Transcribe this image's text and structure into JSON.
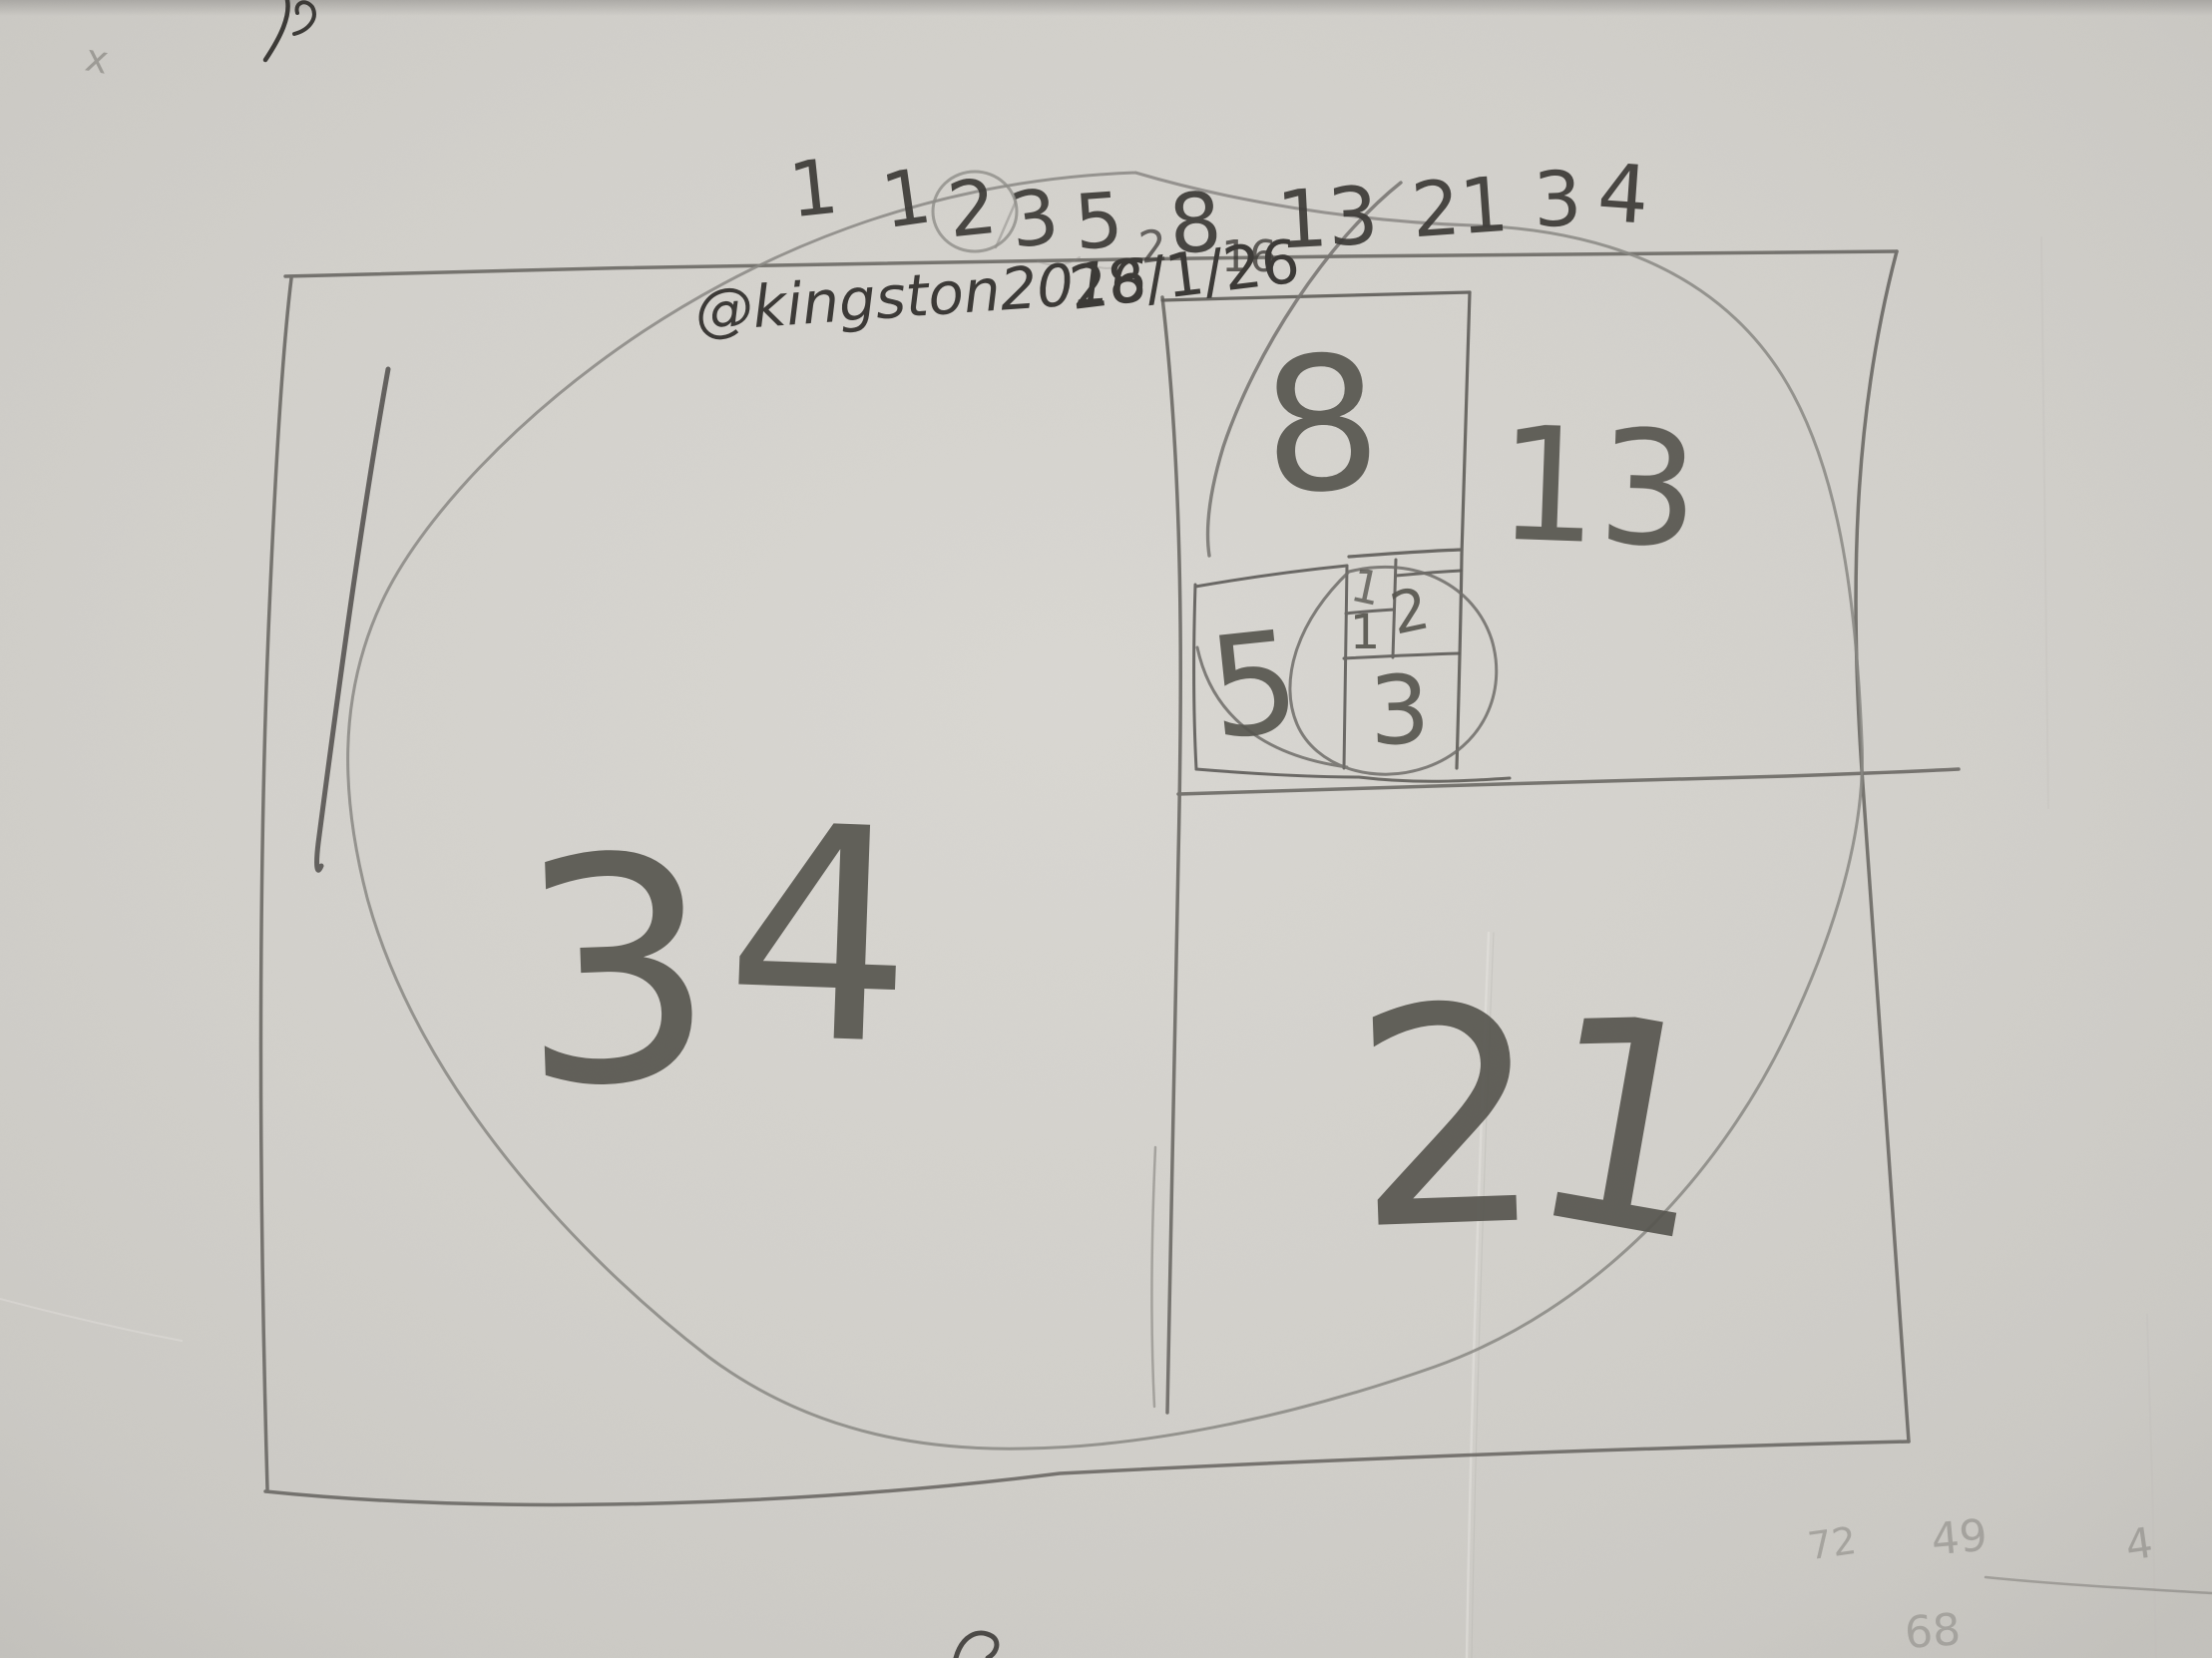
{
  "artwork": {
    "kind": "hand-drawn Fibonacci spiral sketch, pencil on paper"
  },
  "sequence_row": {
    "n0": "1",
    "n1": "1",
    "n2": "2",
    "n3": "3",
    "n4": "5",
    "n5_prefix": "2",
    "n5": "8",
    "n5_suffix": "16",
    "n6": "13",
    "n7": "21",
    "n8": "3",
    "n9": "4"
  },
  "signature_row": {
    "handle": "@kingston2016",
    "date": "28/1/26"
  },
  "square_labels": {
    "s34_d1": "3",
    "s34_d2": "4",
    "s21_d1": "2",
    "s21_d2": "1",
    "s13": "13",
    "s8": "8",
    "s5": "5",
    "s3": "3",
    "s2": "2",
    "s1_top": "1",
    "s1_bottom": "1"
  },
  "margin_notes": {
    "top_left_x": "x",
    "bottom_right_a": "72",
    "bottom_right_b": "49",
    "bottom_right_c": "4",
    "bottom_right_d": "68"
  },
  "colors": {
    "paper": "#d2d0cb",
    "pencil": "#6b6965",
    "pencil_dark": "#3c3a37",
    "pencil_light": "#8a8884"
  }
}
